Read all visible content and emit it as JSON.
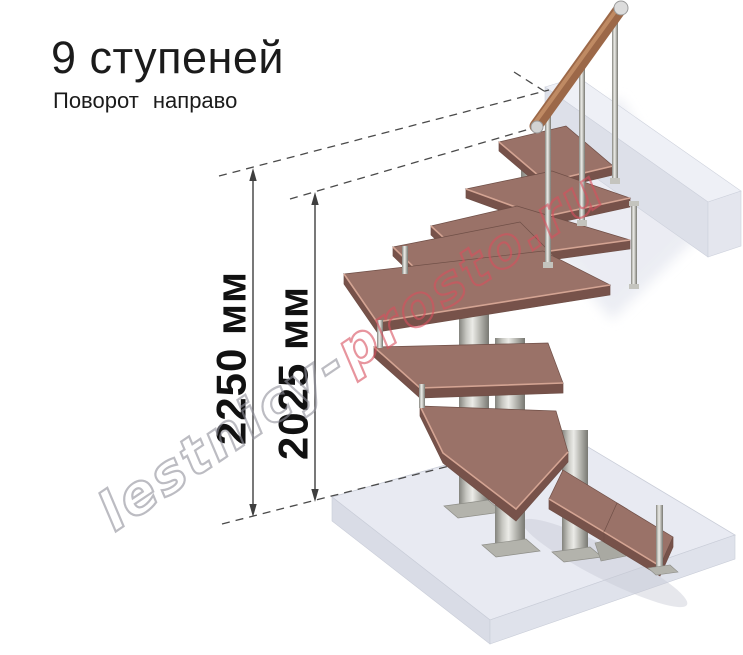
{
  "title": "9 ступеней",
  "subtitle": "Поворот направо",
  "dimensions": {
    "overall_height": "2250 мм",
    "height_to_last_step": "2025 мм"
  },
  "watermark": {
    "part1": "lestnicy-",
    "part2": "prosto.ru",
    "full_text": "lestnicy-prosto.ru"
  },
  "staircase": {
    "steps_count": 9,
    "turn_direction": "направо"
  },
  "colors": {
    "text": "#1b1b1b",
    "dimension_lines": "#3f3f3f",
    "tread_top": "#9a7268",
    "tread_front": "#77524a",
    "tread_highlight": "#d4a493",
    "metal_light": "#ebebe7",
    "metal_dark": "#83837d",
    "floor_top": "#e8eaf2",
    "handrail_wood": "#9c6848",
    "watermark_gray": "#90909b",
    "watermark_red": "#d8505e"
  }
}
